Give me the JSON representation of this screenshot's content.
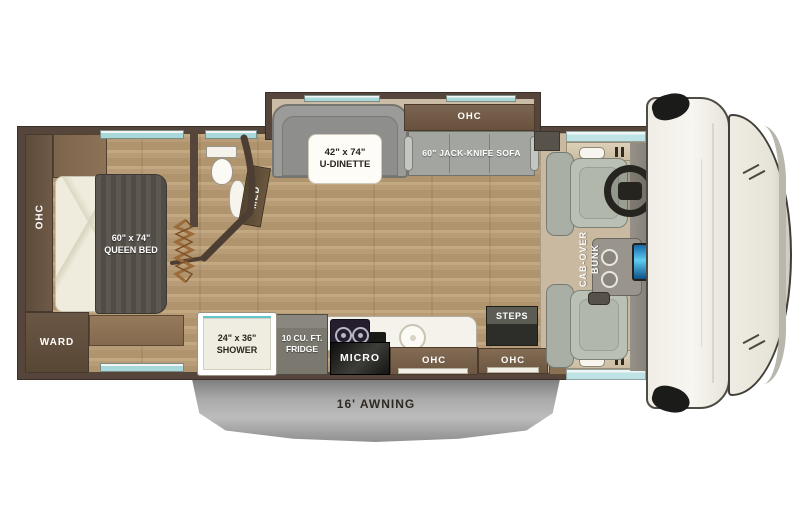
{
  "plan": {
    "bedroom": {
      "ohc": "OHC",
      "ward": "WARD",
      "bed_size": "60\" x 74\"",
      "bed_name": "QUEEN BED"
    },
    "bath": {
      "med": "MED"
    },
    "dinette": {
      "size": "42\" x 74\"",
      "name": "U-DINETTE"
    },
    "sofa": {
      "ohc": "OHC",
      "label": "60\" JACK-KNIFE SOFA"
    },
    "kitchen": {
      "shower_size": "24\" x 36\"",
      "shower_name": "SHOWER",
      "fridge_line1": "10 CU. FT.",
      "fridge_line2": "FRIDGE",
      "micro": "MICRO",
      "ohc": "OHC"
    },
    "entry": {
      "steps": "STEPS",
      "ohc": "OHC",
      "tv": "TV"
    },
    "cab": {
      "bunk_line1": "CAB-OVER",
      "bunk_line2": "BUNK"
    },
    "awning": {
      "label": "16' AWNING"
    },
    "colors": {
      "wall_brown": "#55453a",
      "floor_wood": "#b79c77",
      "window_teal": "#a8d8da",
      "awning_gray": "#a9a9a9",
      "dash_screen_blue": "#5fcdf2"
    }
  }
}
